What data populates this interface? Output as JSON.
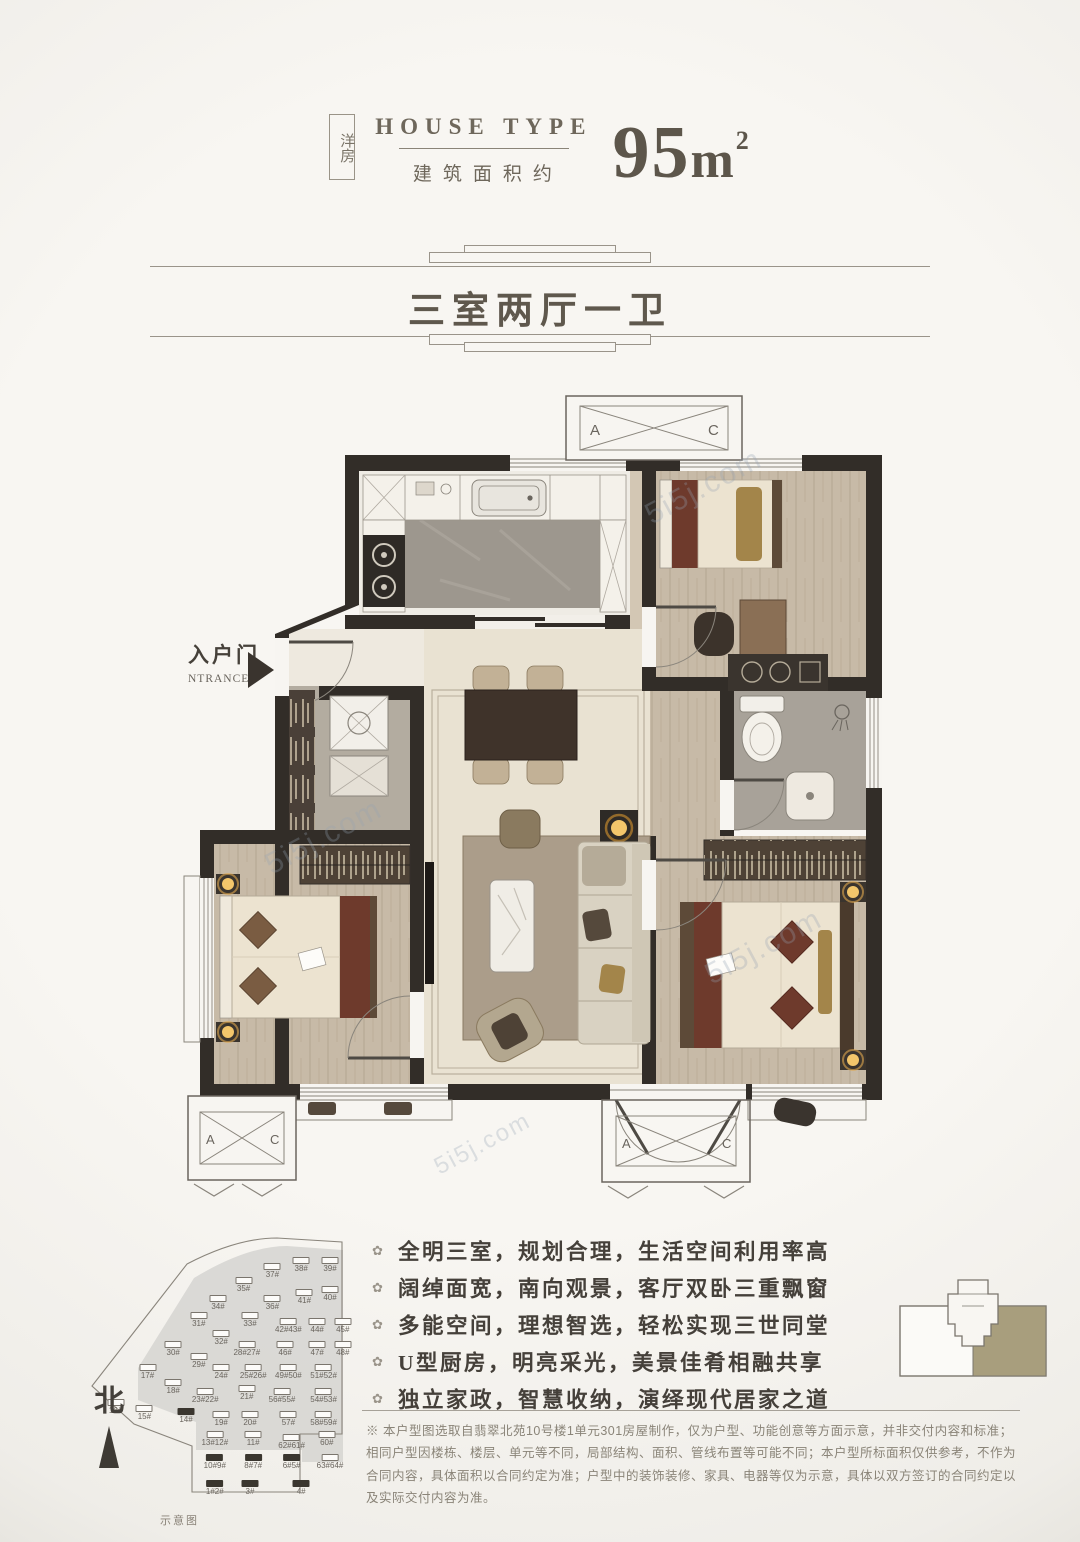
{
  "watermark": "5i5j.com",
  "header": {
    "tag": "洋房",
    "title_en": "HOUSE TYPE",
    "subtitle_cn": "建筑面积约",
    "area_number": "95",
    "area_unit": "m",
    "area_exp": "2"
  },
  "banner": {
    "title": "三室两厅一卫"
  },
  "plan": {
    "entrance_cn": "入户门",
    "entrance_en": "NTRANCE",
    "ac_a": "A",
    "ac_c": "C"
  },
  "features": {
    "bullet": "✿",
    "items": [
      "全明三室，规划合理，生活空间利用率高",
      "阔绰面宽，南向观景，客厅双卧三重飘窗",
      "多能空间，理想智选，轻松实现三世同堂",
      "U型厨房，明亮采光，美景佳肴相融共享",
      "独立家政，智慧收纳，演绎现代居家之道"
    ]
  },
  "disclaimer": "※ 本户型图选取自翡翠北苑10号楼1单元301房屋制作，仅为户型、功能创意等方面示意，并非交付内容和标准；相同户型因楼栋、楼层、单元等不同，局部结构、面积、管线布置等可能不同；本户型所标面积仅供参考，不作为合同内容，具体面积以合同约定为准；户型中的装饰装修、家具、电器等仅为示意，具体以双方签订的合同约定以及实际交付内容为准。",
  "site_plan": {
    "north": "北",
    "caption": "示意图",
    "buildings": [
      {
        "label": "37#",
        "x": 72,
        "y": 12,
        "dark": false
      },
      {
        "label": "38#",
        "x": 81,
        "y": 10,
        "dark": false
      },
      {
        "label": "39#",
        "x": 90,
        "y": 10,
        "dark": false
      },
      {
        "label": "35#",
        "x": 63,
        "y": 17,
        "dark": false
      },
      {
        "label": "34#",
        "x": 55,
        "y": 23,
        "dark": false
      },
      {
        "label": "36#",
        "x": 72,
        "y": 23,
        "dark": false
      },
      {
        "label": "41#",
        "x": 82,
        "y": 21,
        "dark": false
      },
      {
        "label": "40#",
        "x": 90,
        "y": 20,
        "dark": false
      },
      {
        "label": "31#",
        "x": 49,
        "y": 29,
        "dark": false
      },
      {
        "label": "33#",
        "x": 65,
        "y": 29,
        "dark": false
      },
      {
        "label": "42#43#",
        "x": 77,
        "y": 31,
        "dark": false
      },
      {
        "label": "44#",
        "x": 86,
        "y": 31,
        "dark": false
      },
      {
        "label": "45#",
        "x": 94,
        "y": 31,
        "dark": false
      },
      {
        "label": "32#",
        "x": 56,
        "y": 35,
        "dark": false
      },
      {
        "label": "30#",
        "x": 41,
        "y": 39,
        "dark": false
      },
      {
        "label": "28#27#",
        "x": 64,
        "y": 39,
        "dark": false
      },
      {
        "label": "46#",
        "x": 76,
        "y": 39,
        "dark": false
      },
      {
        "label": "47#",
        "x": 86,
        "y": 39,
        "dark": false
      },
      {
        "label": "48#",
        "x": 94,
        "y": 39,
        "dark": false
      },
      {
        "label": "29#",
        "x": 49,
        "y": 43,
        "dark": false
      },
      {
        "label": "24#",
        "x": 56,
        "y": 47,
        "dark": false
      },
      {
        "label": "25#26#",
        "x": 66,
        "y": 47,
        "dark": false
      },
      {
        "label": "49#50#",
        "x": 77,
        "y": 47,
        "dark": false
      },
      {
        "label": "51#52#",
        "x": 88,
        "y": 47,
        "dark": false
      },
      {
        "label": "17#",
        "x": 33,
        "y": 47,
        "dark": false
      },
      {
        "label": "18#",
        "x": 41,
        "y": 52,
        "dark": false
      },
      {
        "label": "23#22#",
        "x": 51,
        "y": 55,
        "dark": false
      },
      {
        "label": "21#",
        "x": 64,
        "y": 54,
        "dark": false
      },
      {
        "label": "56#55#",
        "x": 75,
        "y": 55,
        "dark": false
      },
      {
        "label": "54#53#",
        "x": 88,
        "y": 55,
        "dark": false
      },
      {
        "label": "16#",
        "x": 23,
        "y": 59,
        "dark": false
      },
      {
        "label": "15#",
        "x": 32,
        "y": 61,
        "dark": false
      },
      {
        "label": "14#",
        "x": 45,
        "y": 62,
        "dark": true
      },
      {
        "label": "19#",
        "x": 56,
        "y": 63,
        "dark": false
      },
      {
        "label": "20#",
        "x": 65,
        "y": 63,
        "dark": false
      },
      {
        "label": "57#",
        "x": 77,
        "y": 63,
        "dark": false
      },
      {
        "label": "58#59#",
        "x": 88,
        "y": 63,
        "dark": false
      },
      {
        "label": "13#12#",
        "x": 54,
        "y": 70,
        "dark": false
      },
      {
        "label": "11#",
        "x": 66,
        "y": 70,
        "dark": false
      },
      {
        "label": "62#61#",
        "x": 78,
        "y": 71,
        "dark": false
      },
      {
        "label": "60#",
        "x": 89,
        "y": 70,
        "dark": false
      },
      {
        "label": "10#9#",
        "x": 54,
        "y": 78,
        "dark": true
      },
      {
        "label": "8#7#",
        "x": 66,
        "y": 78,
        "dark": true
      },
      {
        "label": "6#5#",
        "x": 78,
        "y": 78,
        "dark": true
      },
      {
        "label": "63#64#",
        "x": 90,
        "y": 78,
        "dark": false
      },
      {
        "label": "1#2#",
        "x": 54,
        "y": 87,
        "dark": true
      },
      {
        "label": "3#",
        "x": 65,
        "y": 87,
        "dark": true
      },
      {
        "label": "4#",
        "x": 81,
        "y": 87,
        "dark": true
      }
    ]
  },
  "colors": {
    "wall": "#322d28",
    "accent_olive": "#a89e7d",
    "text_dark": "#45403a",
    "cream_floor": "#e9e2d2"
  }
}
